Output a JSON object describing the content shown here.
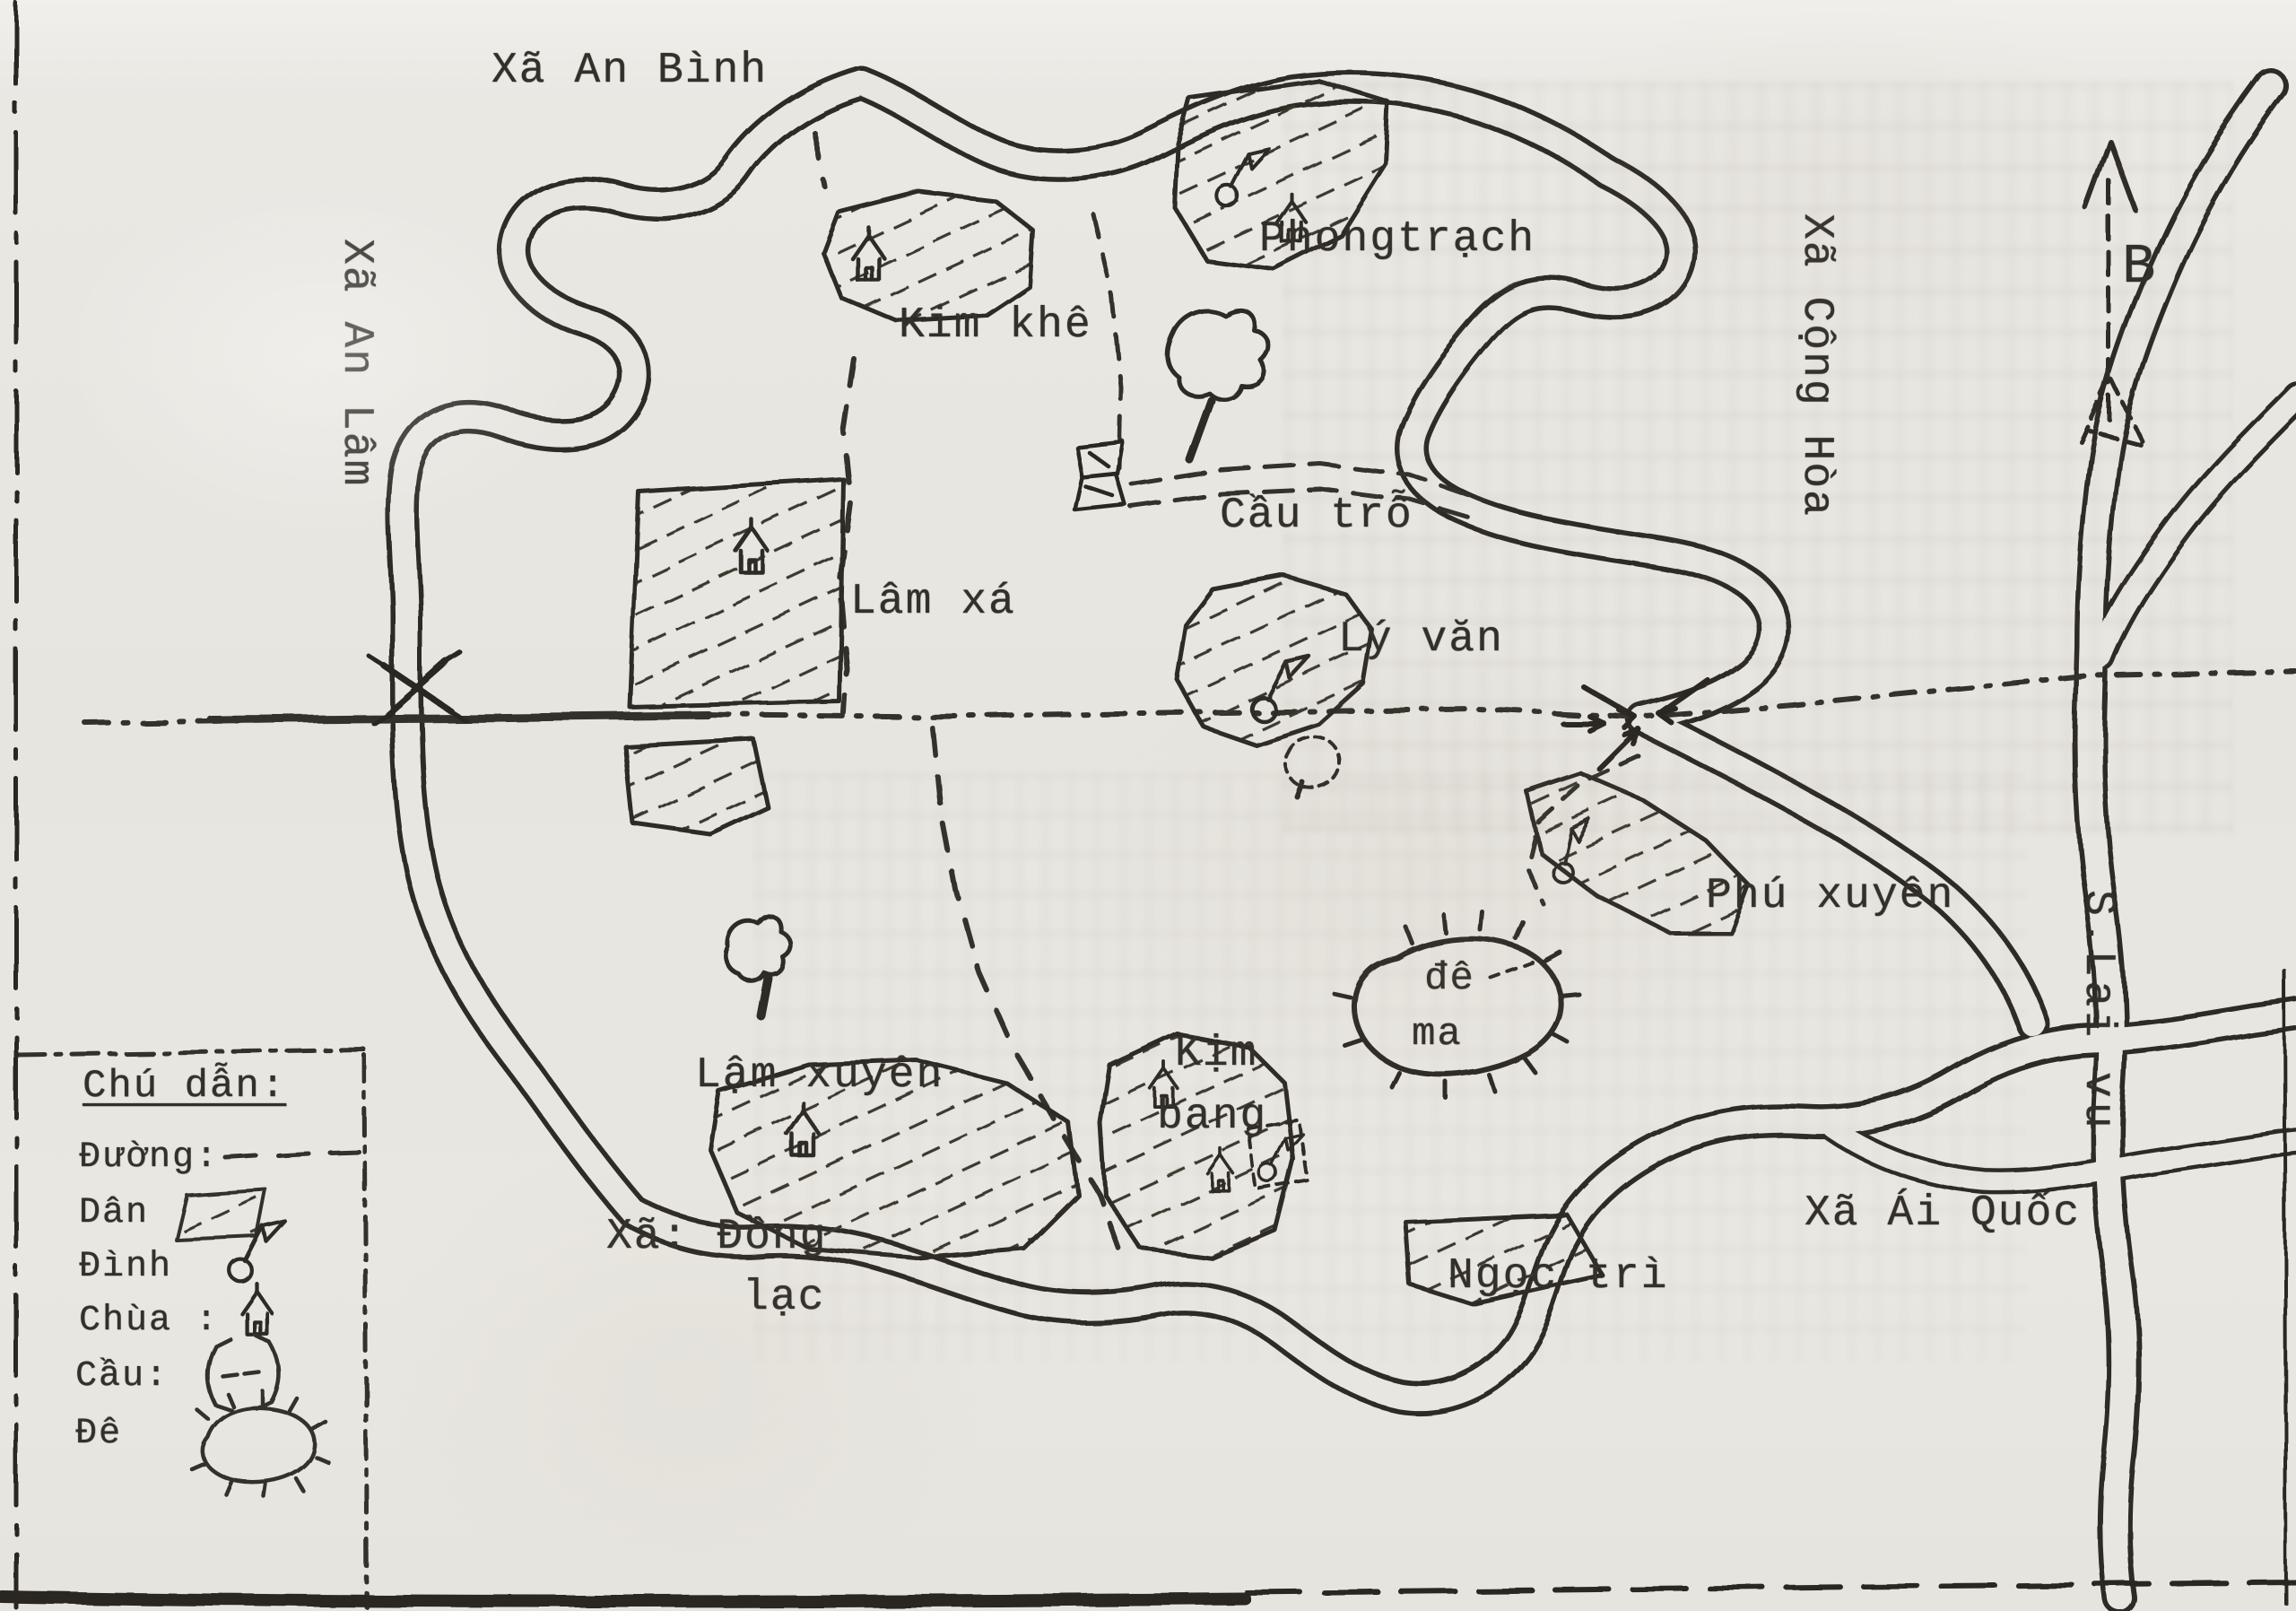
{
  "map": {
    "kind": "hand-drawn scanned map with typewriter labels",
    "language": "Vietnamese"
  },
  "labels": {
    "xa_an_binh": "Xã An Bình",
    "xa_an_lam": "Xã An Lâm",
    "kim_khe": "Kim khê",
    "phong_trach": "Phongtrạch",
    "xa_cong_hoa": "Xã Cộng Hòa",
    "lam_xa": "Lâm xá",
    "cau_tro": "Cầu trỗ",
    "ly_van": "Lý văn",
    "phu_xuyen": "Phú xuyên",
    "s_lai_vu": "S.Lai vu",
    "de_ma_line1": "đê",
    "de_ma_line2": "ma",
    "lam_xuyen": "Lậm xuyên",
    "kim_bang_line1": "Kịm",
    "kim_bang_line2": "bang",
    "xa_dong_lac_line1": "Xã: Đồng",
    "xa_dong_lac_line2": "lạc",
    "ngoc_tri": "Ngọc trì",
    "xa_ai_quoc": "Xã Ái Quốc"
  },
  "compass": {
    "north_letter": "B"
  },
  "legend": {
    "title": "Chú dẫn:",
    "road": "Đường:",
    "settlement": "Dân",
    "communal_house": "Đình",
    "pagoda": "Chùa :",
    "bridge": "Cầu:",
    "dike": "Đê"
  },
  "icons": {
    "chua": "pagoda-house-icon",
    "dinh": "circle-with-pennant-icon",
    "cau": "bridge-crossing-icon",
    "de": "dike-mound-with-ticks-icon",
    "dan": "hatched-settlement-swatch",
    "compass": "north-arrow-icon"
  },
  "colors": {
    "paper": "#e8e6e1",
    "ink": "#34312b"
  }
}
